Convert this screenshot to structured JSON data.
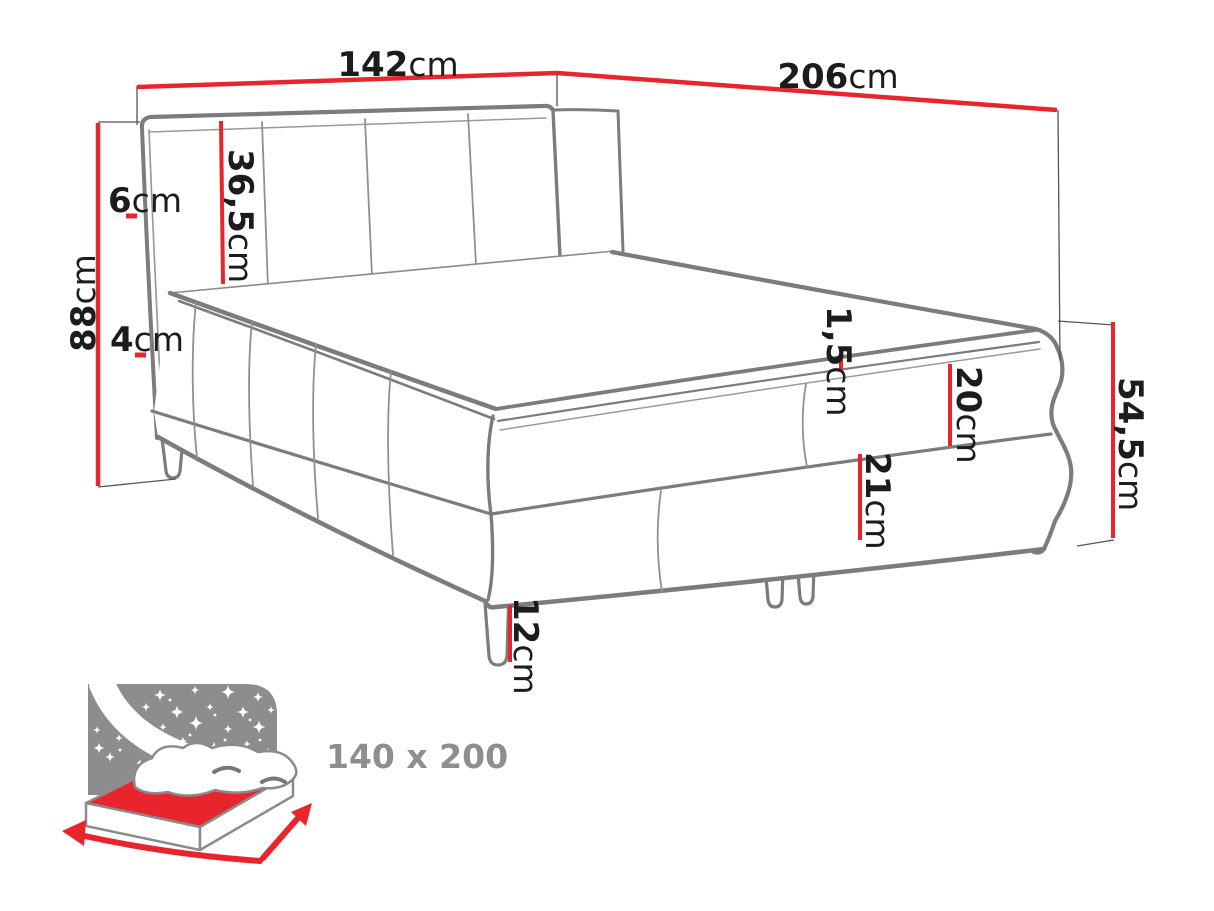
{
  "diagram": {
    "dimension_labels": {
      "headboard_width": {
        "value": "142",
        "unit": "cm"
      },
      "bed_length": {
        "value": "206",
        "unit": "cm"
      },
      "total_height": {
        "value": "88",
        "unit": "cm"
      },
      "headboard_thickness": {
        "value": "6",
        "unit": "cm"
      },
      "headboard_panel_height": {
        "value": "36,5",
        "unit": "cm"
      },
      "frame_offset": {
        "value": "4",
        "unit": "cm"
      },
      "topper_seam": {
        "value": "1,5",
        "unit": "cm"
      },
      "upper_box_height": {
        "value": "20",
        "unit": "cm"
      },
      "lower_box_height": {
        "value": "21",
        "unit": "cm"
      },
      "side_height": {
        "value": "54,5",
        "unit": "cm"
      },
      "leg_height": {
        "value": "12",
        "unit": "cm"
      }
    },
    "size_badge": {
      "label": "140 x 200"
    },
    "colors": {
      "dimension_red": "#e8242c",
      "outline_gray": "#7c7c7c",
      "icon_gray": "#8d8d8d",
      "label_black": "#1c1c1c",
      "size_label_gray": "#8e8e8e",
      "background": "#ffffff"
    }
  }
}
